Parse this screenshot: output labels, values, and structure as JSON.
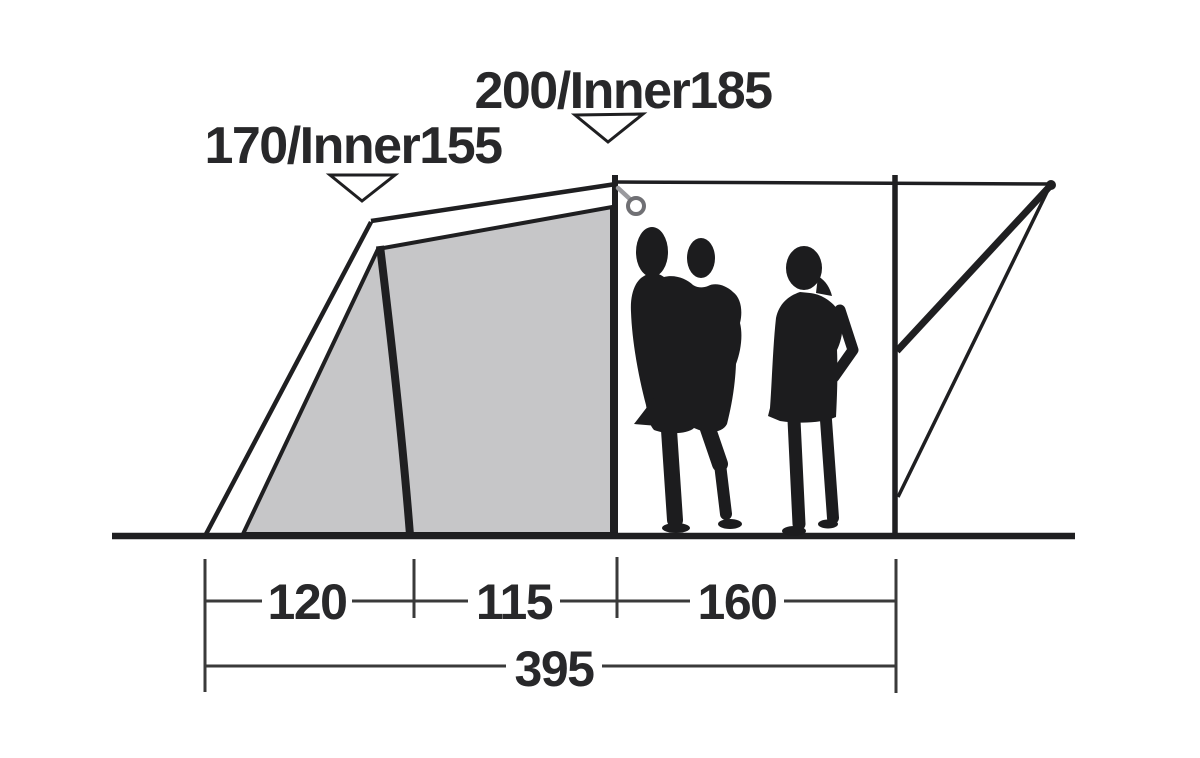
{
  "figure": {
    "name": "tent-side-profile-dimension-diagram",
    "height_labels": [
      {
        "text": "170/Inner155"
      },
      {
        "text": "200/Inner185"
      }
    ],
    "width_segments": [
      {
        "value": "120"
      },
      {
        "value": "115"
      },
      {
        "value": "160"
      }
    ],
    "total_width": {
      "value": "395"
    },
    "icons": {
      "pointer_triangle": "downward-triangle-pointer",
      "guy_ring": "guy-line-ring"
    },
    "colors": {
      "background": "#ffffff",
      "line": "#1f1f21",
      "inner_tent_fill": "#c6c6c8",
      "silhouette": "#1c1c1e",
      "dimension_line": "#3a3a3a",
      "text": "#28282a",
      "ring": "#707074"
    }
  }
}
